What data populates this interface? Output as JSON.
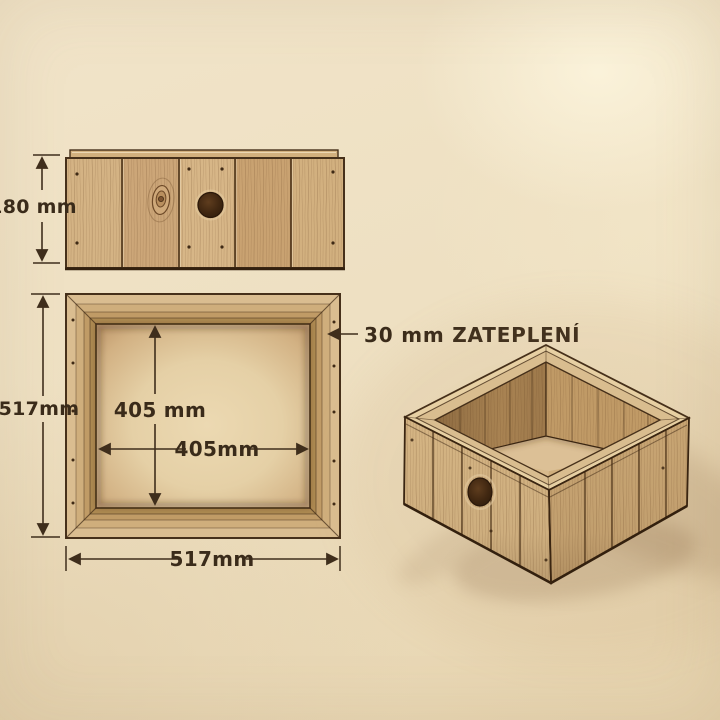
{
  "labels": {
    "elevation_height": "180 mm",
    "plan_outer_height": "517mm",
    "plan_inner_height": "405 mm",
    "plan_inner_width": "405mm",
    "plan_outer_width": "517mm",
    "insulation_callout": "30 mm ZATEPLENÍ"
  },
  "colors": {
    "paper": "#eee0c2",
    "ink": "#3f2e1c",
    "wood_light": "#d9bc8e",
    "wood_mid": "#c9a571",
    "wood_dark": "#46301a",
    "hole": "#3a2412"
  }
}
